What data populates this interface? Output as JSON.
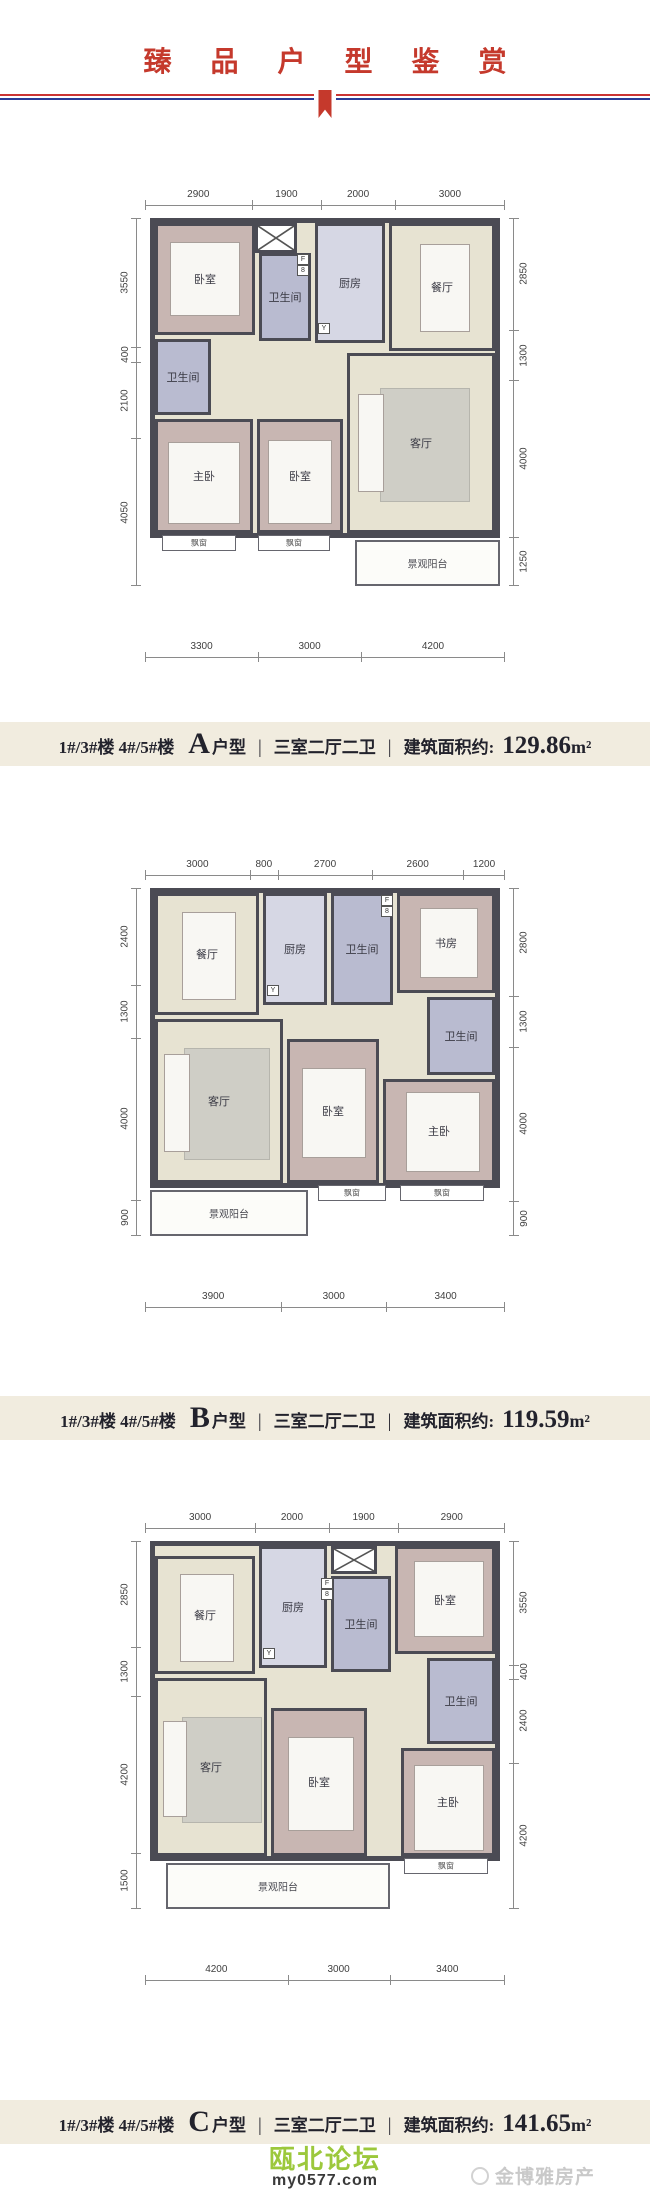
{
  "header": {
    "title": "臻 品 户 型 鉴 赏"
  },
  "colors": {
    "accent_red": "#c5392c",
    "rule_blue": "#2c3c96",
    "forum_green": "#9cc83c",
    "wall": "#4b4b54",
    "bedroom_fill": "#c8b6b2",
    "living_fill": "#e7e3d2",
    "bath_fill": "#b9bbd0",
    "caption_band": "#f1ecdf"
  },
  "caption_separator": "|",
  "room_labels": {
    "bedroom": "卧室",
    "master_bedroom": "主卧",
    "living_room": "客厅",
    "dining_room": "餐厅",
    "kitchen": "厨房",
    "bathroom": "卫生间",
    "study": "书房",
    "balcony": "景观阳台",
    "bay_window": "飘窗",
    "flue_tag": "F",
    "heater_tag": "8",
    "drain_tag": "Y"
  },
  "plans": [
    {
      "name": "A户型",
      "caption": {
        "building": "1#/3#楼  4#/5#楼",
        "type_letter": "A",
        "type_word": "户型",
        "layout": "三室二厅二卫",
        "area_label": "建筑面积约:",
        "area_value": "129.86",
        "area_unit": "m²"
      },
      "dims": {
        "top": [
          "2900",
          "1900",
          "2000",
          "3000"
        ],
        "left": [
          "3550",
          "400",
          "2100",
          "4050"
        ],
        "right": [
          "2850",
          "1300",
          "4000",
          "1250"
        ],
        "bottom": [
          "3300",
          "3000",
          "4200"
        ]
      }
    },
    {
      "name": "B户型",
      "caption": {
        "building": "1#/3#楼  4#/5#楼",
        "type_letter": "B",
        "type_word": "户型",
        "layout": "三室二厅二卫",
        "area_label": "建筑面积约:",
        "area_value": "119.59",
        "area_unit": "m²"
      },
      "dims": {
        "top": [
          "3000",
          "800",
          "2700",
          "2600",
          "1200"
        ],
        "left": [
          "2400",
          "1300",
          "4000",
          "900"
        ],
        "right": [
          "2800",
          "1300",
          "4000",
          "900"
        ],
        "bottom": [
          "3900",
          "3000",
          "3400"
        ]
      }
    },
    {
      "name": "C户型",
      "caption": {
        "building": "1#/3#楼  4#/5#楼",
        "type_letter": "C",
        "type_word": "户型",
        "layout": "三室二厅二卫",
        "area_label": "建筑面积约:",
        "area_value": "141.65",
        "area_unit": "m²"
      },
      "dims": {
        "top": [
          "3000",
          "2000",
          "1900",
          "2900"
        ],
        "left": [
          "2850",
          "1300",
          "4200",
          "1500"
        ],
        "right": [
          "3550",
          "400",
          "2400",
          "4200"
        ],
        "bottom": [
          "4200",
          "3000",
          "3400"
        ]
      }
    }
  ],
  "footer": {
    "forum_name": "瓯北论坛",
    "forum_url": "my0577.com",
    "agency": "金博雅房产"
  }
}
